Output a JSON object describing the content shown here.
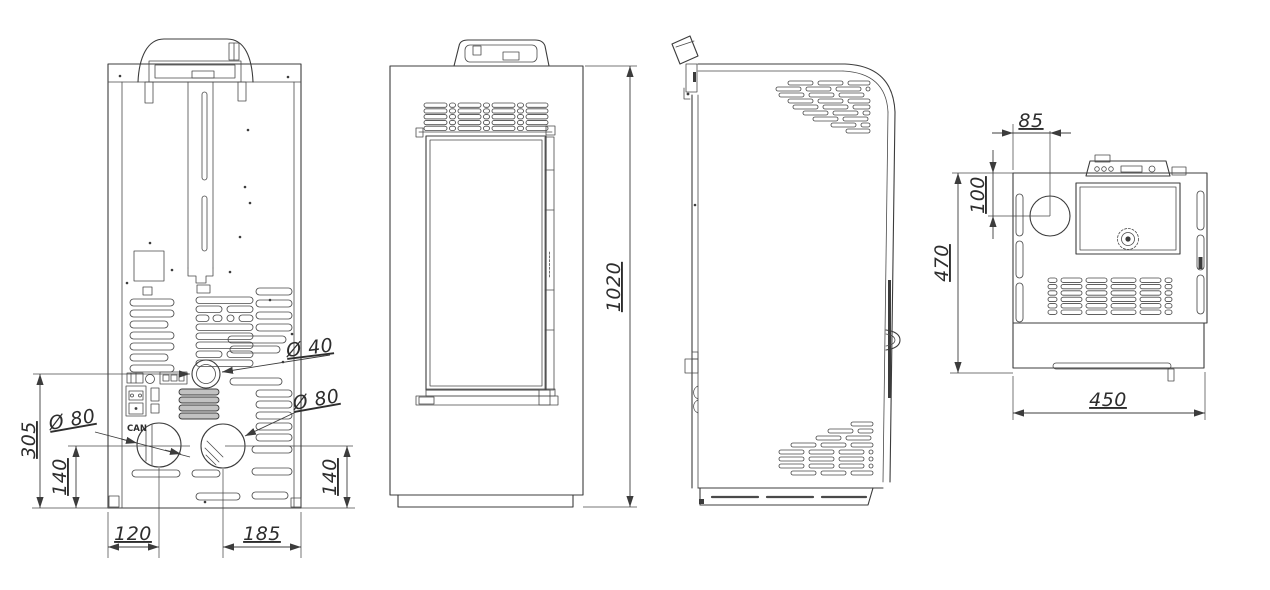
{
  "drawing": {
    "background_color": "#ffffff",
    "line_color": "#3c3c3c",
    "views": {
      "rear": {
        "labels": {
          "flue_diameter": "Ø 40",
          "left_port_diameter": "Ø 80",
          "right_port_diameter": "Ø 80",
          "flue_center_height": "305",
          "left_port_height": "140",
          "right_port_height": "140",
          "left_port_offset": "120",
          "right_port_offset": "185",
          "can_port": "CAN"
        }
      },
      "front": {
        "labels": {
          "overall_height": "1020"
        }
      },
      "top": {
        "labels": {
          "flue_offset_x": "85",
          "flue_offset_y": "100",
          "overall_depth": "470",
          "overall_width": "450"
        }
      }
    }
  }
}
